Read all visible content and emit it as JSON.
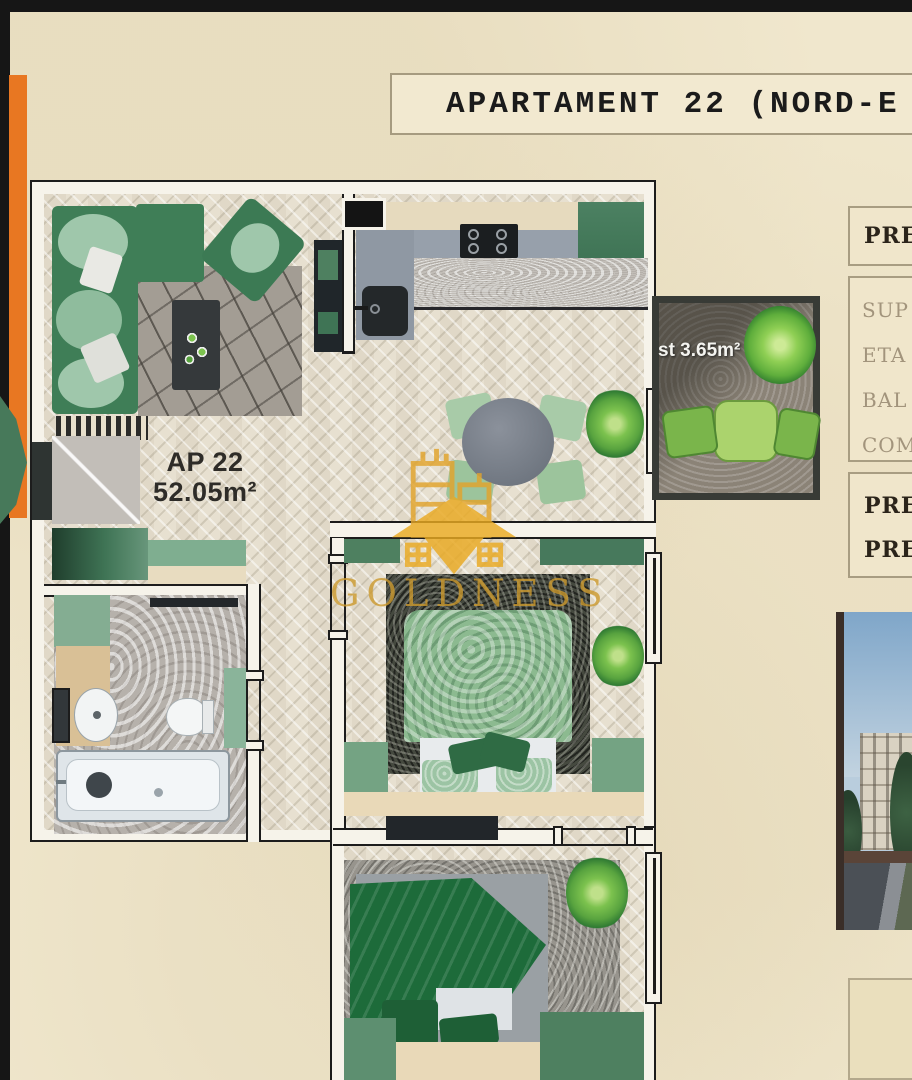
{
  "header": {
    "title": "APARTAMENT 22 (NORD-E"
  },
  "sidebar": {
    "price_box": {
      "label": "PRE"
    },
    "details_box": {
      "items": [
        {
          "label": "SUP"
        },
        {
          "label": "ETA"
        },
        {
          "label": "BAL"
        },
        {
          "label": "COM"
        }
      ]
    },
    "summary_box": {
      "line1": "PRE",
      "line2": "PRE"
    }
  },
  "plan": {
    "apartment_label": "AP 22",
    "apartment_area": "52.05m²",
    "balcony_area": "st 3.65m²"
  },
  "watermark": {
    "text": "GOLDNESS"
  },
  "colors": {
    "background_parchment": "#f0e7cd",
    "accent_orange": "#e87722",
    "brand_gold": "#cc9a2e",
    "wall_outline": "#1c1c1c",
    "furniture_green": "#3f7e57",
    "balcony_green": "#7ab54b",
    "bed_green_light": "#8cba90",
    "bed_green_dark": "#1d6b3a"
  }
}
